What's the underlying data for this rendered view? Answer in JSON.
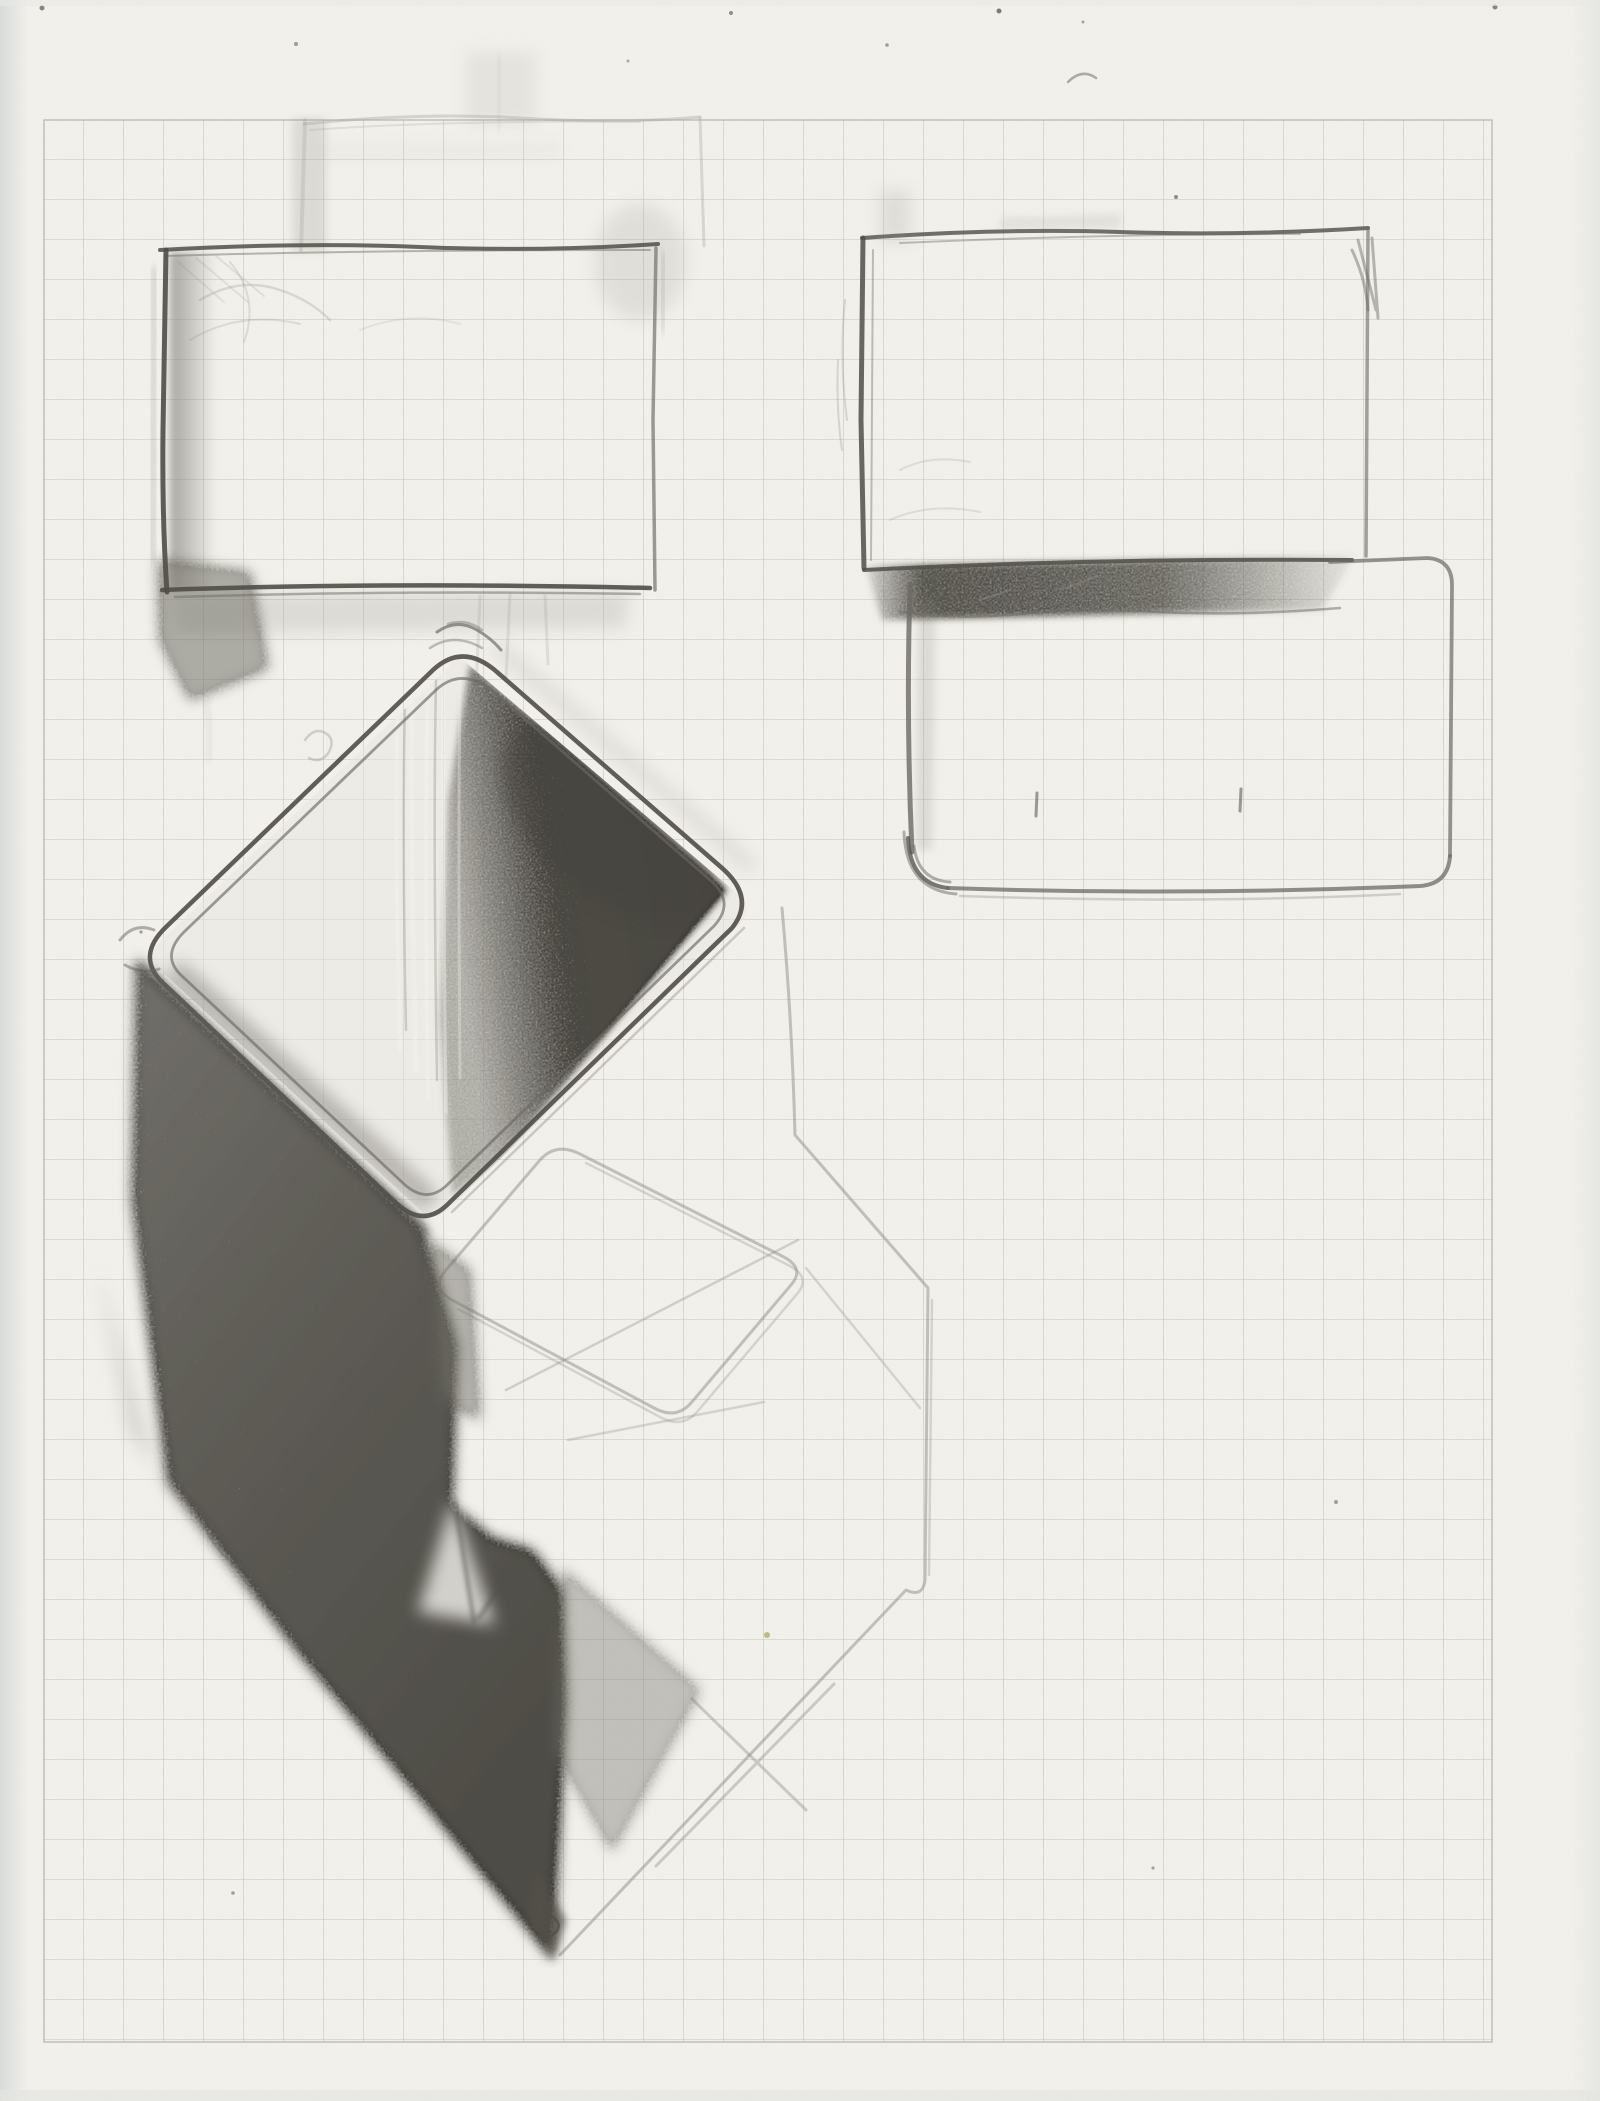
{
  "document": {
    "kind": "scanned pencil sketch on quad-ruled graph paper",
    "page_text": "",
    "objects": [
      {
        "name": "faint-rectangle-top-left",
        "desc": "very light rectangle outline sketched above the main top-left rectangle",
        "bbox": [
          295,
          112,
          710,
          252
        ]
      },
      {
        "name": "rectangle-top-left",
        "desc": "hand-drawn rectangle, shaded left edge, dark bottom edge, smudged bottom-left corner",
        "bbox": [
          158,
          244,
          660,
          594
        ]
      },
      {
        "name": "rectangle-top-right",
        "desc": "hand-drawn rectangle with dark left edge and shaded band along its bottom",
        "bbox": [
          860,
          228,
          1370,
          568
        ]
      },
      {
        "name": "rectangle-bottom-right",
        "desc": "rounded-corner rectangle overlapping below the top-right rectangle, two small tick marks inside",
        "bbox": [
          905,
          552,
          1453,
          892
        ]
      },
      {
        "name": "open-box-cube",
        "desc": "large diamond-oriented open box with double outline, dark graphite interior and shaded left face",
        "bbox": [
          110,
          630,
          770,
          1280
        ]
      },
      {
        "name": "shadow-mass",
        "desc": "heavy graphite shading running from the cube left corner down to a point near the page bottom",
        "bbox": [
          98,
          958,
          710,
          1965
        ]
      },
      {
        "name": "light-cube-outline",
        "desc": "faint second cube sketched below-right with rounded diamond opening and construction lines",
        "bbox": [
          420,
          905,
          940,
          1965
        ]
      }
    ]
  },
  "grid": {
    "cell_px": 40,
    "area": {
      "x": 44,
      "y": 120,
      "width": 1448,
      "height": 1922
    },
    "line_width": 1.1,
    "line_opacity": 0.75
  },
  "colors": {
    "paper": "#f2f1ec",
    "paperHighlight": "#f3f2ec",
    "grid": "#b4b4b0",
    "pencilDark": "#4f4d46",
    "pencil": "#6b6963",
    "pencilLight": "#8f8d84",
    "pencilFaint": "#a9a79f",
    "haze": "#8b897f",
    "graphiteFill": "#6e6c63",
    "graphiteDeep": "#45433c",
    "scanEdge": "#d7d9d9",
    "yellowSpeck": "#b3ad62"
  },
  "specks": [
    {
      "x": 42,
      "y": 8,
      "r": 2.5,
      "c": "#6a6a66"
    },
    {
      "x": 731,
      "y": 13,
      "r": 2.0,
      "c": "#77756f"
    },
    {
      "x": 999,
      "y": 11,
      "r": 2.5,
      "c": "#5f5d58"
    },
    {
      "x": 1495,
      "y": 7,
      "r": 2.5,
      "c": "#6a6a66"
    },
    {
      "x": 296,
      "y": 44,
      "r": 2.0,
      "c": "#8a887f"
    },
    {
      "x": 887,
      "y": 45,
      "r": 1.8,
      "c": "#8a887f"
    },
    {
      "x": 628,
      "y": 61,
      "r": 1.5,
      "c": "#999790"
    },
    {
      "x": 1083,
      "y": 22,
      "r": 1.5,
      "c": "#94928a"
    },
    {
      "x": 1176,
      "y": 197,
      "r": 2.0,
      "c": "#76746d"
    },
    {
      "x": 141,
      "y": 932,
      "r": 1.6,
      "c": "#8a887f"
    },
    {
      "x": 1336,
      "y": 1502,
      "r": 2.0,
      "c": "#8d8b82"
    },
    {
      "x": 767,
      "y": 1635,
      "r": 3.0,
      "c": "#b3ad62"
    },
    {
      "x": 233,
      "y": 1893,
      "r": 1.8,
      "c": "#8a887f"
    },
    {
      "x": 1153,
      "y": 1868,
      "r": 1.6,
      "c": "#8f8d84"
    }
  ]
}
